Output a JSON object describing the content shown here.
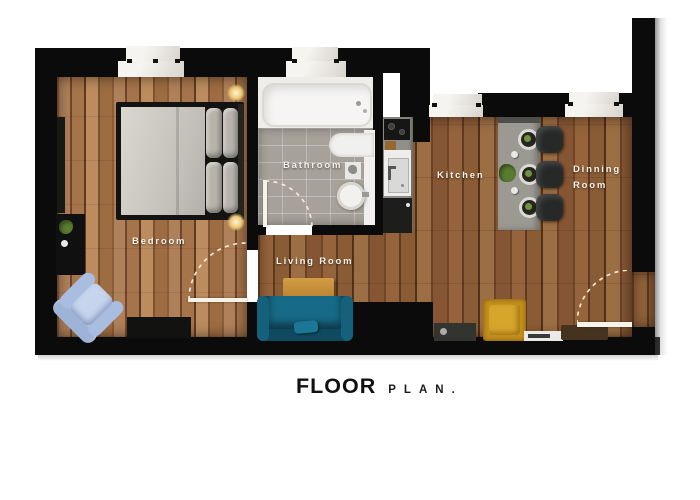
{
  "title": {
    "floor": "FLOOR",
    "plan": "PLAN",
    "period": "."
  },
  "rooms": {
    "bedroom": {
      "label": "Bedroom"
    },
    "bathroom": {
      "label": "Bathroom"
    },
    "living_room": {
      "label": "Living Room"
    },
    "kitchen": {
      "label": "Kitchen"
    },
    "dining_room": {
      "label_line1": "Dinning",
      "label_line2": "Room"
    }
  },
  "palette": {
    "wall": "#0b0b0b",
    "wood_floor": "#8a5c36",
    "bedroom_wood": "#a5744a",
    "bathroom_tile": "#a6a29a",
    "bathroom_white": "#efedea",
    "sofa_teal": "#15607a",
    "armchair_blue": "#aec3e3",
    "armchair_gold": "#c28e1c",
    "bench_brown": "#46331f",
    "counter_gray": "#98978f",
    "stool_charcoal": "#272928",
    "door_swing_line": "#f3e9d6",
    "room_label_text": "#f5f2ea",
    "title_text": "#111111"
  }
}
